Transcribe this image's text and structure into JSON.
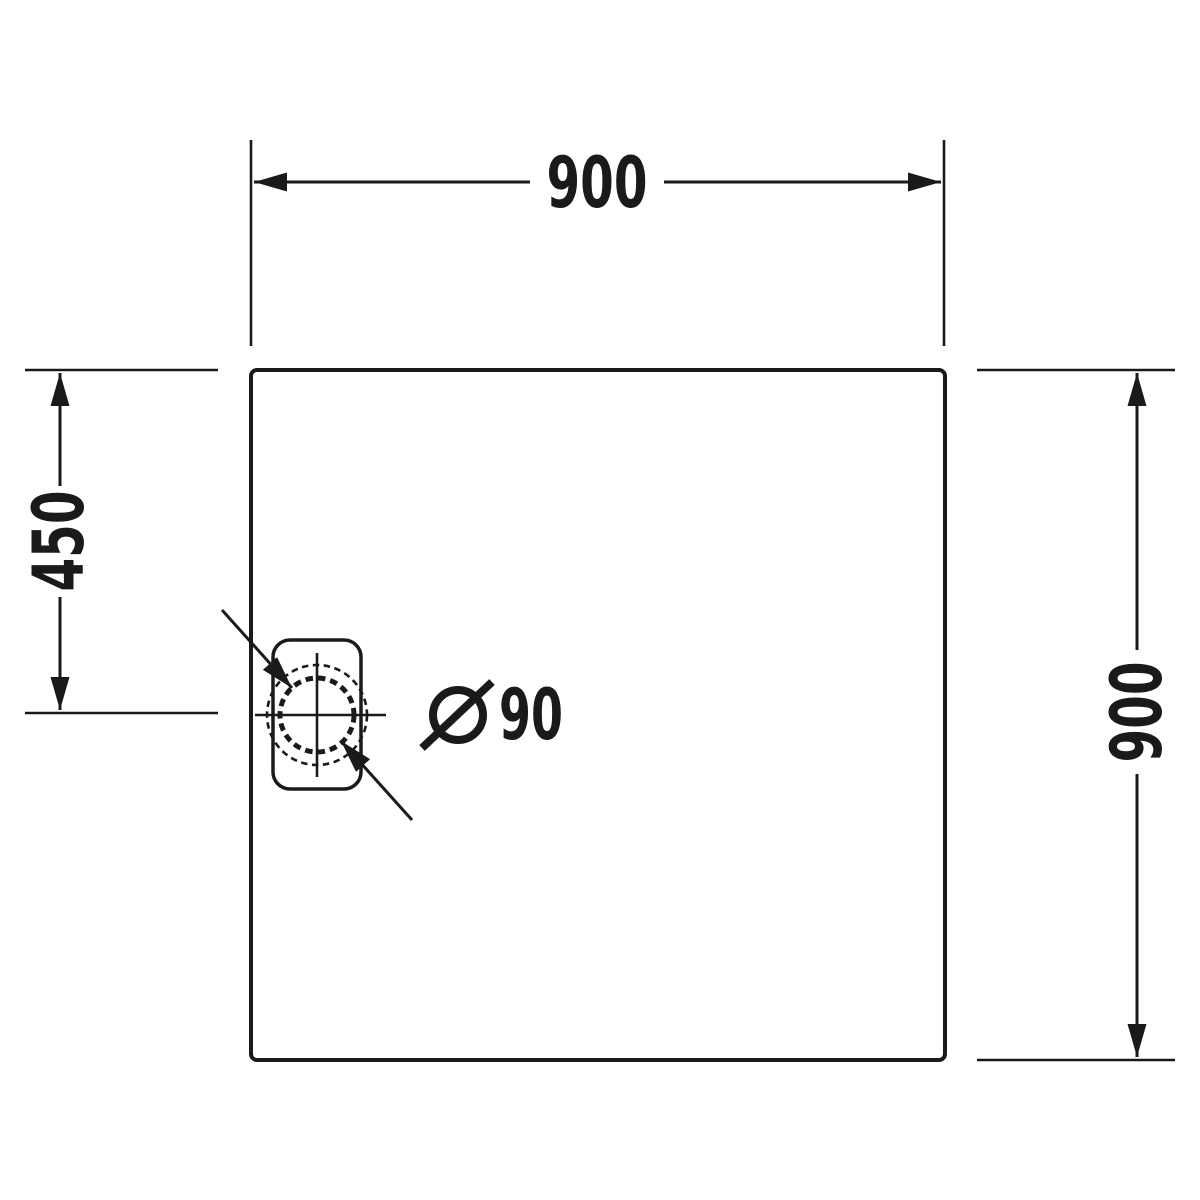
{
  "dimensions": {
    "top_width_label": "900",
    "right_height_label": "900",
    "left_drain_offset_label": "450",
    "drain_diameter_value": "90",
    "drain_diameter_symbol": "Ø",
    "drain_diameter_full_label": "Ø 90"
  },
  "colors": {
    "line": "#1a1a1a",
    "background": "#ffffff"
  }
}
